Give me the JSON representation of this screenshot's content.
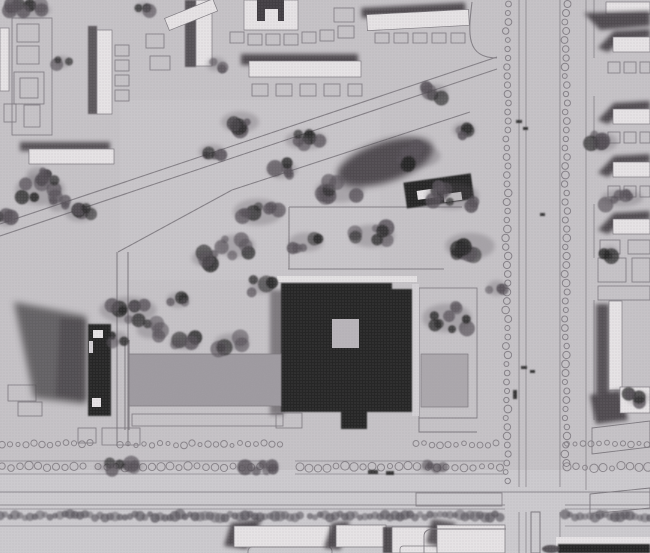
{
  "meta": {
    "description": "Black-and-white aerial photograph of an architectural model: dark square tower with light inner courtyard, park with trees and diagonal paths, tree-lined boulevard, slab housing blocks"
  },
  "colors": {
    "ground": "#c6c3c7",
    "ground_light": "#d4d1d5",
    "roof_white": "#e7e4e6",
    "outline": "#7c787e",
    "building_dark": "#242122",
    "shadow": "#3f3b40",
    "tree": "#545057",
    "plaza": "#9e9aa0",
    "pool": "#aba7ac",
    "hedge": "#56525a"
  },
  "trees": {
    "clusters": [
      [
        28,
        10,
        24,
        9,
        8
      ],
      [
        62,
        62,
        9,
        6,
        3
      ],
      [
        216,
        64,
        10,
        7,
        3
      ],
      [
        144,
        8,
        9,
        6,
        3
      ],
      [
        434,
        92,
        14,
        8,
        4
      ],
      [
        464,
        130,
        12,
        8,
        4
      ],
      [
        240,
        122,
        20,
        11,
        6
      ],
      [
        212,
        152,
        14,
        8,
        4
      ],
      [
        306,
        140,
        22,
        10,
        6
      ],
      [
        282,
        170,
        16,
        9,
        5
      ],
      [
        340,
        190,
        26,
        13,
        8
      ],
      [
        418,
        156,
        24,
        12,
        7
      ],
      [
        452,
        196,
        28,
        14,
        8
      ],
      [
        258,
        212,
        26,
        14,
        8
      ],
      [
        236,
        246,
        20,
        12,
        6
      ],
      [
        306,
        242,
        18,
        10,
        5
      ],
      [
        372,
        236,
        24,
        12,
        7
      ],
      [
        470,
        246,
        26,
        14,
        8
      ],
      [
        497,
        288,
        10,
        8,
        3
      ],
      [
        205,
        258,
        14,
        9,
        5
      ],
      [
        40,
        190,
        26,
        16,
        8
      ],
      [
        80,
        212,
        16,
        10,
        5
      ],
      [
        6,
        218,
        10,
        9,
        3
      ],
      [
        128,
        310,
        30,
        14,
        8
      ],
      [
        150,
        330,
        14,
        9,
        4
      ],
      [
        185,
        342,
        16,
        8,
        5
      ],
      [
        232,
        342,
        18,
        9,
        5
      ],
      [
        178,
        300,
        12,
        8,
        4
      ],
      [
        262,
        286,
        13,
        8,
        4
      ],
      [
        118,
        338,
        10,
        7,
        3
      ],
      [
        447,
        318,
        26,
        15,
        9
      ],
      [
        602,
        142,
        16,
        10,
        5
      ],
      [
        622,
        198,
        22,
        9,
        6
      ],
      [
        638,
        398,
        12,
        7,
        4
      ],
      [
        610,
        252,
        8,
        6,
        3
      ],
      [
        120,
        467,
        26,
        5,
        7
      ],
      [
        258,
        467,
        22,
        5,
        6
      ],
      [
        432,
        468,
        14,
        5,
        4
      ],
      [
        38,
        175,
        12,
        8,
        4
      ],
      [
        58,
        205,
        10,
        7,
        3
      ]
    ]
  },
  "boulevard": {
    "tree_columns": [
      {
        "x": 507,
        "y1": 4,
        "y2": 484,
        "step": 9,
        "r": 3.0
      },
      {
        "x": 566,
        "y1": 4,
        "y2": 468,
        "step": 9,
        "r": 3.0
      }
    ]
  },
  "rows": {
    "dotted": [
      {
        "y": 444,
        "step": 8,
        "r": 2.5,
        "segs": [
          [
            2,
            92
          ],
          [
            120,
            284
          ],
          [
            416,
            500
          ],
          [
            567,
            648
          ]
        ]
      },
      {
        "y": 467,
        "step": 9,
        "r": 3.2,
        "segs": [
          [
            2,
            88
          ],
          [
            98,
            268
          ],
          [
            300,
            420
          ],
          [
            428,
            502
          ],
          [
            567,
            648
          ]
        ]
      }
    ],
    "hedge": {
      "y": 516,
      "step": 5,
      "r": 4.2,
      "segs": [
        [
          0,
          302
        ],
        [
          310,
          503
        ],
        [
          565,
          650
        ]
      ]
    }
  },
  "parcels": [
    [
      12,
      18,
      40,
      117
    ],
    [
      17,
      24,
      22,
      18
    ],
    [
      17,
      46,
      22,
      18
    ],
    [
      14,
      72,
      30,
      32
    ],
    [
      20,
      78,
      18,
      20
    ],
    [
      24,
      105,
      16,
      22
    ],
    [
      4,
      104,
      12,
      18
    ],
    [
      115,
      45,
      14,
      11
    ],
    [
      115,
      60,
      14,
      11
    ],
    [
      115,
      75,
      14,
      11
    ],
    [
      115,
      90,
      14,
      11
    ],
    [
      146,
      34,
      18,
      14
    ],
    [
      150,
      56,
      20,
      14
    ],
    [
      230,
      32,
      14,
      11
    ],
    [
      248,
      34,
      14,
      11
    ],
    [
      266,
      34,
      14,
      11
    ],
    [
      284,
      34,
      14,
      11
    ],
    [
      302,
      32,
      14,
      11
    ],
    [
      320,
      30,
      14,
      11
    ],
    [
      334,
      8,
      20,
      14
    ],
    [
      338,
      26,
      16,
      12
    ],
    [
      252,
      84,
      16,
      12
    ],
    [
      276,
      84,
      16,
      12
    ],
    [
      300,
      84,
      16,
      12
    ],
    [
      324,
      84,
      16,
      12
    ],
    [
      348,
      84,
      14,
      12
    ],
    [
      375,
      33,
      14,
      10
    ],
    [
      394,
      33,
      14,
      10
    ],
    [
      413,
      33,
      14,
      10
    ],
    [
      432,
      33,
      14,
      10
    ],
    [
      451,
      33,
      14,
      10
    ],
    [
      608,
      62,
      12,
      11
    ],
    [
      624,
      62,
      12,
      11
    ],
    [
      640,
      62,
      10,
      11
    ],
    [
      608,
      132,
      12,
      11
    ],
    [
      624,
      132,
      12,
      11
    ],
    [
      640,
      132,
      10,
      11
    ],
    [
      608,
      186,
      12,
      11
    ],
    [
      624,
      186,
      12,
      11
    ],
    [
      640,
      186,
      10,
      11
    ],
    [
      600,
      240,
      20,
      14
    ],
    [
      628,
      240,
      22,
      14
    ],
    [
      598,
      258,
      28,
      24
    ],
    [
      632,
      258,
      18,
      24
    ],
    [
      598,
      286,
      52,
      14
    ],
    [
      78,
      428,
      18,
      15
    ],
    [
      102,
      428,
      38,
      17
    ],
    [
      8,
      385,
      28,
      16
    ],
    [
      18,
      402,
      24,
      14
    ],
    [
      132,
      414,
      151,
      12
    ],
    [
      419,
      288,
      58,
      130
    ],
    [
      416,
      493,
      86,
      13
    ]
  ],
  "right_slabs": {
    "y_list": [
      28,
      100,
      153,
      210
    ]
  },
  "specks": [
    [
      516,
      120,
      6,
      3
    ],
    [
      523,
      127,
      5,
      3
    ],
    [
      540,
      213,
      5,
      3
    ],
    [
      521,
      366,
      6,
      3
    ],
    [
      530,
      370,
      5,
      3
    ],
    [
      368,
      470,
      10,
      4
    ],
    [
      386,
      471,
      8,
      4
    ],
    [
      513,
      390,
      4,
      9
    ]
  ]
}
